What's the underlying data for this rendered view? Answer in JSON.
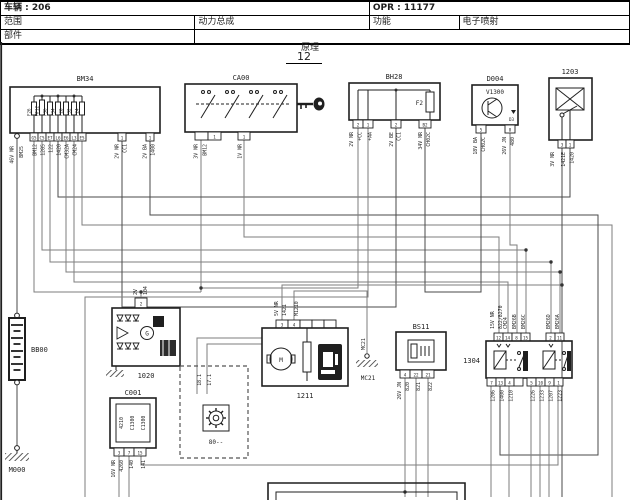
{
  "header": {
    "vehicle": "车辆 : 206",
    "opr": "OPR : 11177",
    "scope_label": "范围",
    "scope_value": "动力总成",
    "function_label": "功能",
    "function_value": "电子喷射",
    "parts_label": "部件",
    "title": "原理",
    "page": "12"
  },
  "colors": {
    "wire": "#7d7d7d",
    "line": "#1f1f1f",
    "background": "#ffffff"
  },
  "bm34": {
    "label": "BM34",
    "fuses": [
      "F26",
      "MF12",
      "F36",
      "F34",
      "F28",
      "F32",
      "F24"
    ],
    "pins": [
      "G5",
      "C5",
      "E7",
      "L6",
      "E6",
      "L3",
      "E5"
    ],
    "wire_gauge": "46V NR",
    "wires": [
      "BM25",
      "BM12",
      "1285",
      "122",
      "1420",
      "CM32A",
      "CM24"
    ],
    "right_pins": [
      "1",
      "1"
    ],
    "right_wires": [
      {
        "gauge": "2V NR",
        "name": "CC1"
      },
      {
        "gauge": "2V BA",
        "name": "1400"
      }
    ]
  },
  "ca00": {
    "label": "CA00",
    "pin1": "1",
    "pin2": "1",
    "wires": [
      "3V NR",
      "BM12",
      "1V NR"
    ]
  },
  "bh28": {
    "label": "BH28",
    "fuse": "F2",
    "pins": [
      "2",
      "1",
      "2",
      "B2"
    ],
    "wires": [
      "2V NR",
      "+CC",
      "+AA",
      "2V BE",
      "CC1",
      "34V NR",
      "CH02C"
    ]
  },
  "d004": {
    "label": "D004",
    "sub": "V1300",
    "diode": "D3",
    "pins": [
      "5",
      "8"
    ],
    "wires": [
      "18V BA",
      "CH02C",
      "26V JN",
      "480"
    ]
  },
  "r1203": {
    "label": "1203",
    "pins": [
      "3",
      "1"
    ],
    "wires": [
      "3V NR",
      "1421E",
      "1420"
    ]
  },
  "bb00": {
    "label": "BB00"
  },
  "m000": {
    "label": "M000"
  },
  "mc21": {
    "label": "MC21",
    "wire": "MC21"
  },
  "a1020": {
    "label": "1020",
    "pin": "2",
    "wires": [
      "2V",
      "104"
    ],
    "b": "B",
    "g": "G"
  },
  "c001": {
    "label": "C001",
    "inner": [
      "4210",
      "C1300",
      "C1300"
    ],
    "pins": [
      "3",
      "7",
      "15"
    ],
    "wires": [
      "16V NR",
      "4260",
      "140",
      "141"
    ]
  },
  "box80": {
    "label": "80--",
    "wires": [
      "18.1",
      "17.1"
    ]
  },
  "p1211": {
    "label": "1211",
    "pins": [
      "3",
      "4"
    ],
    "motor": "M",
    "wires": [
      "5V NR",
      "1421",
      "M1210"
    ]
  },
  "bs11": {
    "label": "BS11",
    "pins": [
      "4",
      "22",
      "21"
    ],
    "wires": [
      "26V JN",
      "820",
      "821",
      "822"
    ]
  },
  "r1304": {
    "label": "1304",
    "top_pins": [
      "12",
      "14",
      "8",
      "15",
      "2",
      "11"
    ],
    "top_gauge": "15V NR",
    "top_wires": [
      "822/8270",
      "CM24",
      "BM26B",
      "BM26C",
      "BM26D",
      "BM26A"
    ],
    "bottom_pins": [
      "7",
      "13",
      "4",
      "5",
      "10",
      "9",
      "1"
    ],
    "bottom_wires": [
      "1206",
      "1400",
      "1210",
      "1226",
      "1233",
      "1207",
      "1223"
    ]
  }
}
